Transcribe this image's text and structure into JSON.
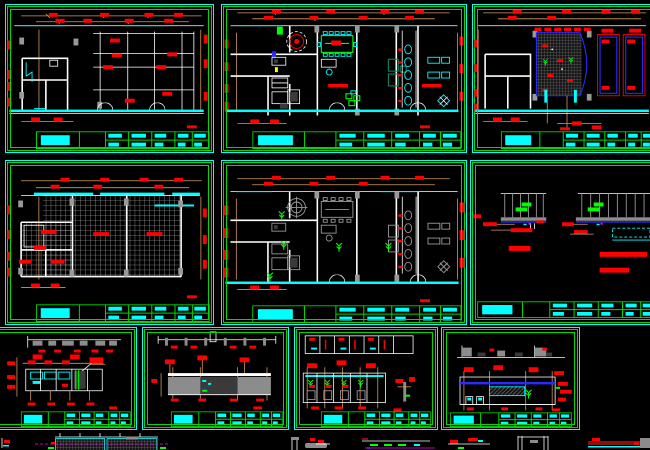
{
  "app": {
    "kind": "cad-drawing-viewport",
    "background": "#000000"
  },
  "colors": {
    "bg": "#000000",
    "cyan": "#00ffff",
    "green": "#00d800",
    "lime": "#00ff00",
    "red": "#ff0000",
    "darkred": "#8a1010",
    "orange": "#d29a60",
    "gray": "#8c8c8c",
    "darkgray": "#3a3a3a",
    "blue": "#2b2bff",
    "magenta": "#ff00ff",
    "yellow": "#ffff00",
    "teal": "#0e8560",
    "white": "#ffffff"
  },
  "sheets": [
    {
      "id": "sheet-1",
      "row": 1,
      "col": 1,
      "kind": "structural floor plan with column grid"
    },
    {
      "id": "sheet-2",
      "row": 1,
      "col": 2,
      "kind": "furnished floor plan"
    },
    {
      "id": "sheet-3",
      "row": 1,
      "col": 3,
      "kind": "partial plan with hatched feature, cut off at right edge"
    },
    {
      "id": "sheet-4",
      "row": 2,
      "col": 1,
      "kind": "reflected ceiling plan with tile grid"
    },
    {
      "id": "sheet-5",
      "row": 2,
      "col": 2,
      "kind": "furniture layout plan"
    },
    {
      "id": "sheet-6",
      "row": 2,
      "col": 3,
      "kind": "ceiling section details, cut off at right edge"
    },
    {
      "id": "sheet-7",
      "row": 3,
      "col": 1,
      "kind": "interior elevation, cut off at left edge"
    },
    {
      "id": "sheet-8",
      "row": 3,
      "col": 2,
      "kind": "interior elevation with dimensioned wall panels"
    },
    {
      "id": "sheet-9",
      "row": 3,
      "col": 3,
      "kind": "toilet partition elevations"
    },
    {
      "id": "sheet-10",
      "row": 3,
      "col": 4,
      "kind": "reception wall elevation"
    }
  ],
  "title_block": {
    "text_color": "#00ffff",
    "border_color": "#00d800",
    "legible": false
  },
  "fragments": {
    "description": "partially visible detail drawings cut by the bottom edge",
    "count": 8
  }
}
